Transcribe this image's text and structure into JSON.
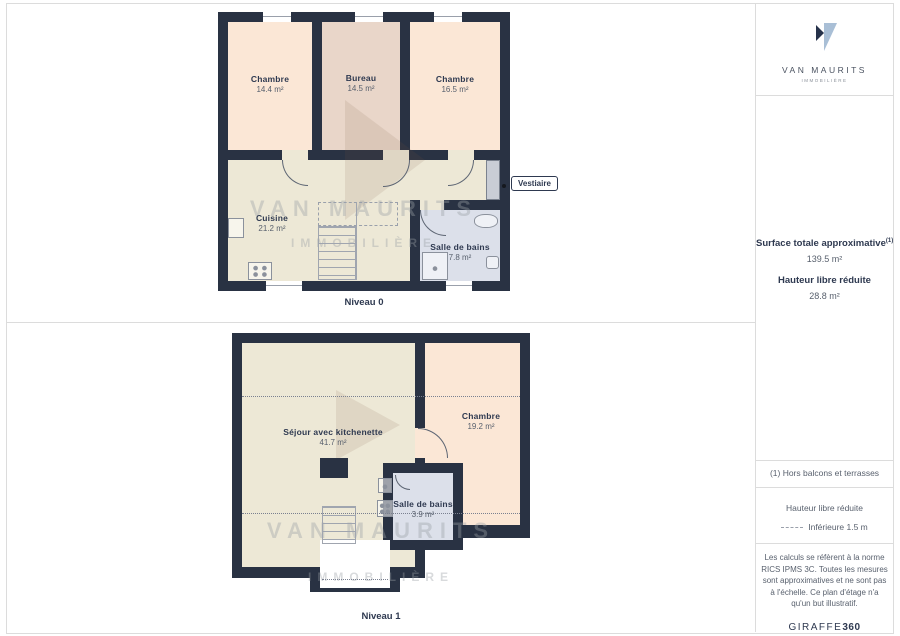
{
  "branding": {
    "logo_title": "VAN MAURITS",
    "logo_subtitle": "IMMOBILIÈRE",
    "watermark_line1": "VAN MAURITS",
    "watermark_line2": "IMMOBILIÈRE",
    "footer_brand": "GIRAFFE",
    "footer_brand_suffix": "360"
  },
  "sidebar": {
    "surface_title": "Surface totale approximative",
    "surface_note_ref": "(1)",
    "surface_value": "139.5 m²",
    "reduced_height_title": "Hauteur libre réduite",
    "reduced_height_value": "28.8 m²",
    "footnote": "(1) Hors balcons et terrasses",
    "legend_title": "Hauteur libre réduite",
    "legend_item": "Inférieure 1.5 m",
    "disclaimer": "Les calculs se réfèrent à la norme RICS IPMS 3C. Toutes les mesures sont approximatives et ne sont pas à l'échelle. Ce plan d'étage n'a qu'un but illustratif."
  },
  "level0": {
    "caption": "Niveau 0",
    "vestiaire_label": "Vestiaire",
    "rooms": [
      {
        "name": "Chambre",
        "area": "14.4 m²"
      },
      {
        "name": "Bureau",
        "area": "14.5 m²"
      },
      {
        "name": "Chambre",
        "area": "16.5 m²"
      },
      {
        "name": "Cuisine",
        "area": "21.2 m²"
      },
      {
        "name": "Salle de bains",
        "area": "7.8 m²"
      }
    ]
  },
  "level1": {
    "caption": "Niveau 1",
    "rooms": [
      {
        "name": "Séjour avec kitchenette",
        "area": "41.7 m²"
      },
      {
        "name": "Chambre",
        "area": "19.2 m²"
      },
      {
        "name": "Salle de bains",
        "area": "3.9 m²"
      }
    ]
  },
  "colors": {
    "wall": "#293243",
    "floor_cream": "#EDE8D6",
    "floor_peach": "#FBE7D6",
    "floor_rose": "#E9D6C9",
    "floor_bath": "#DCE0EA",
    "closet_gray": "#C9CDD5",
    "text_navy": "#2E3950",
    "logo_dark": "#26324A",
    "logo_light": "#A9BFD6"
  }
}
